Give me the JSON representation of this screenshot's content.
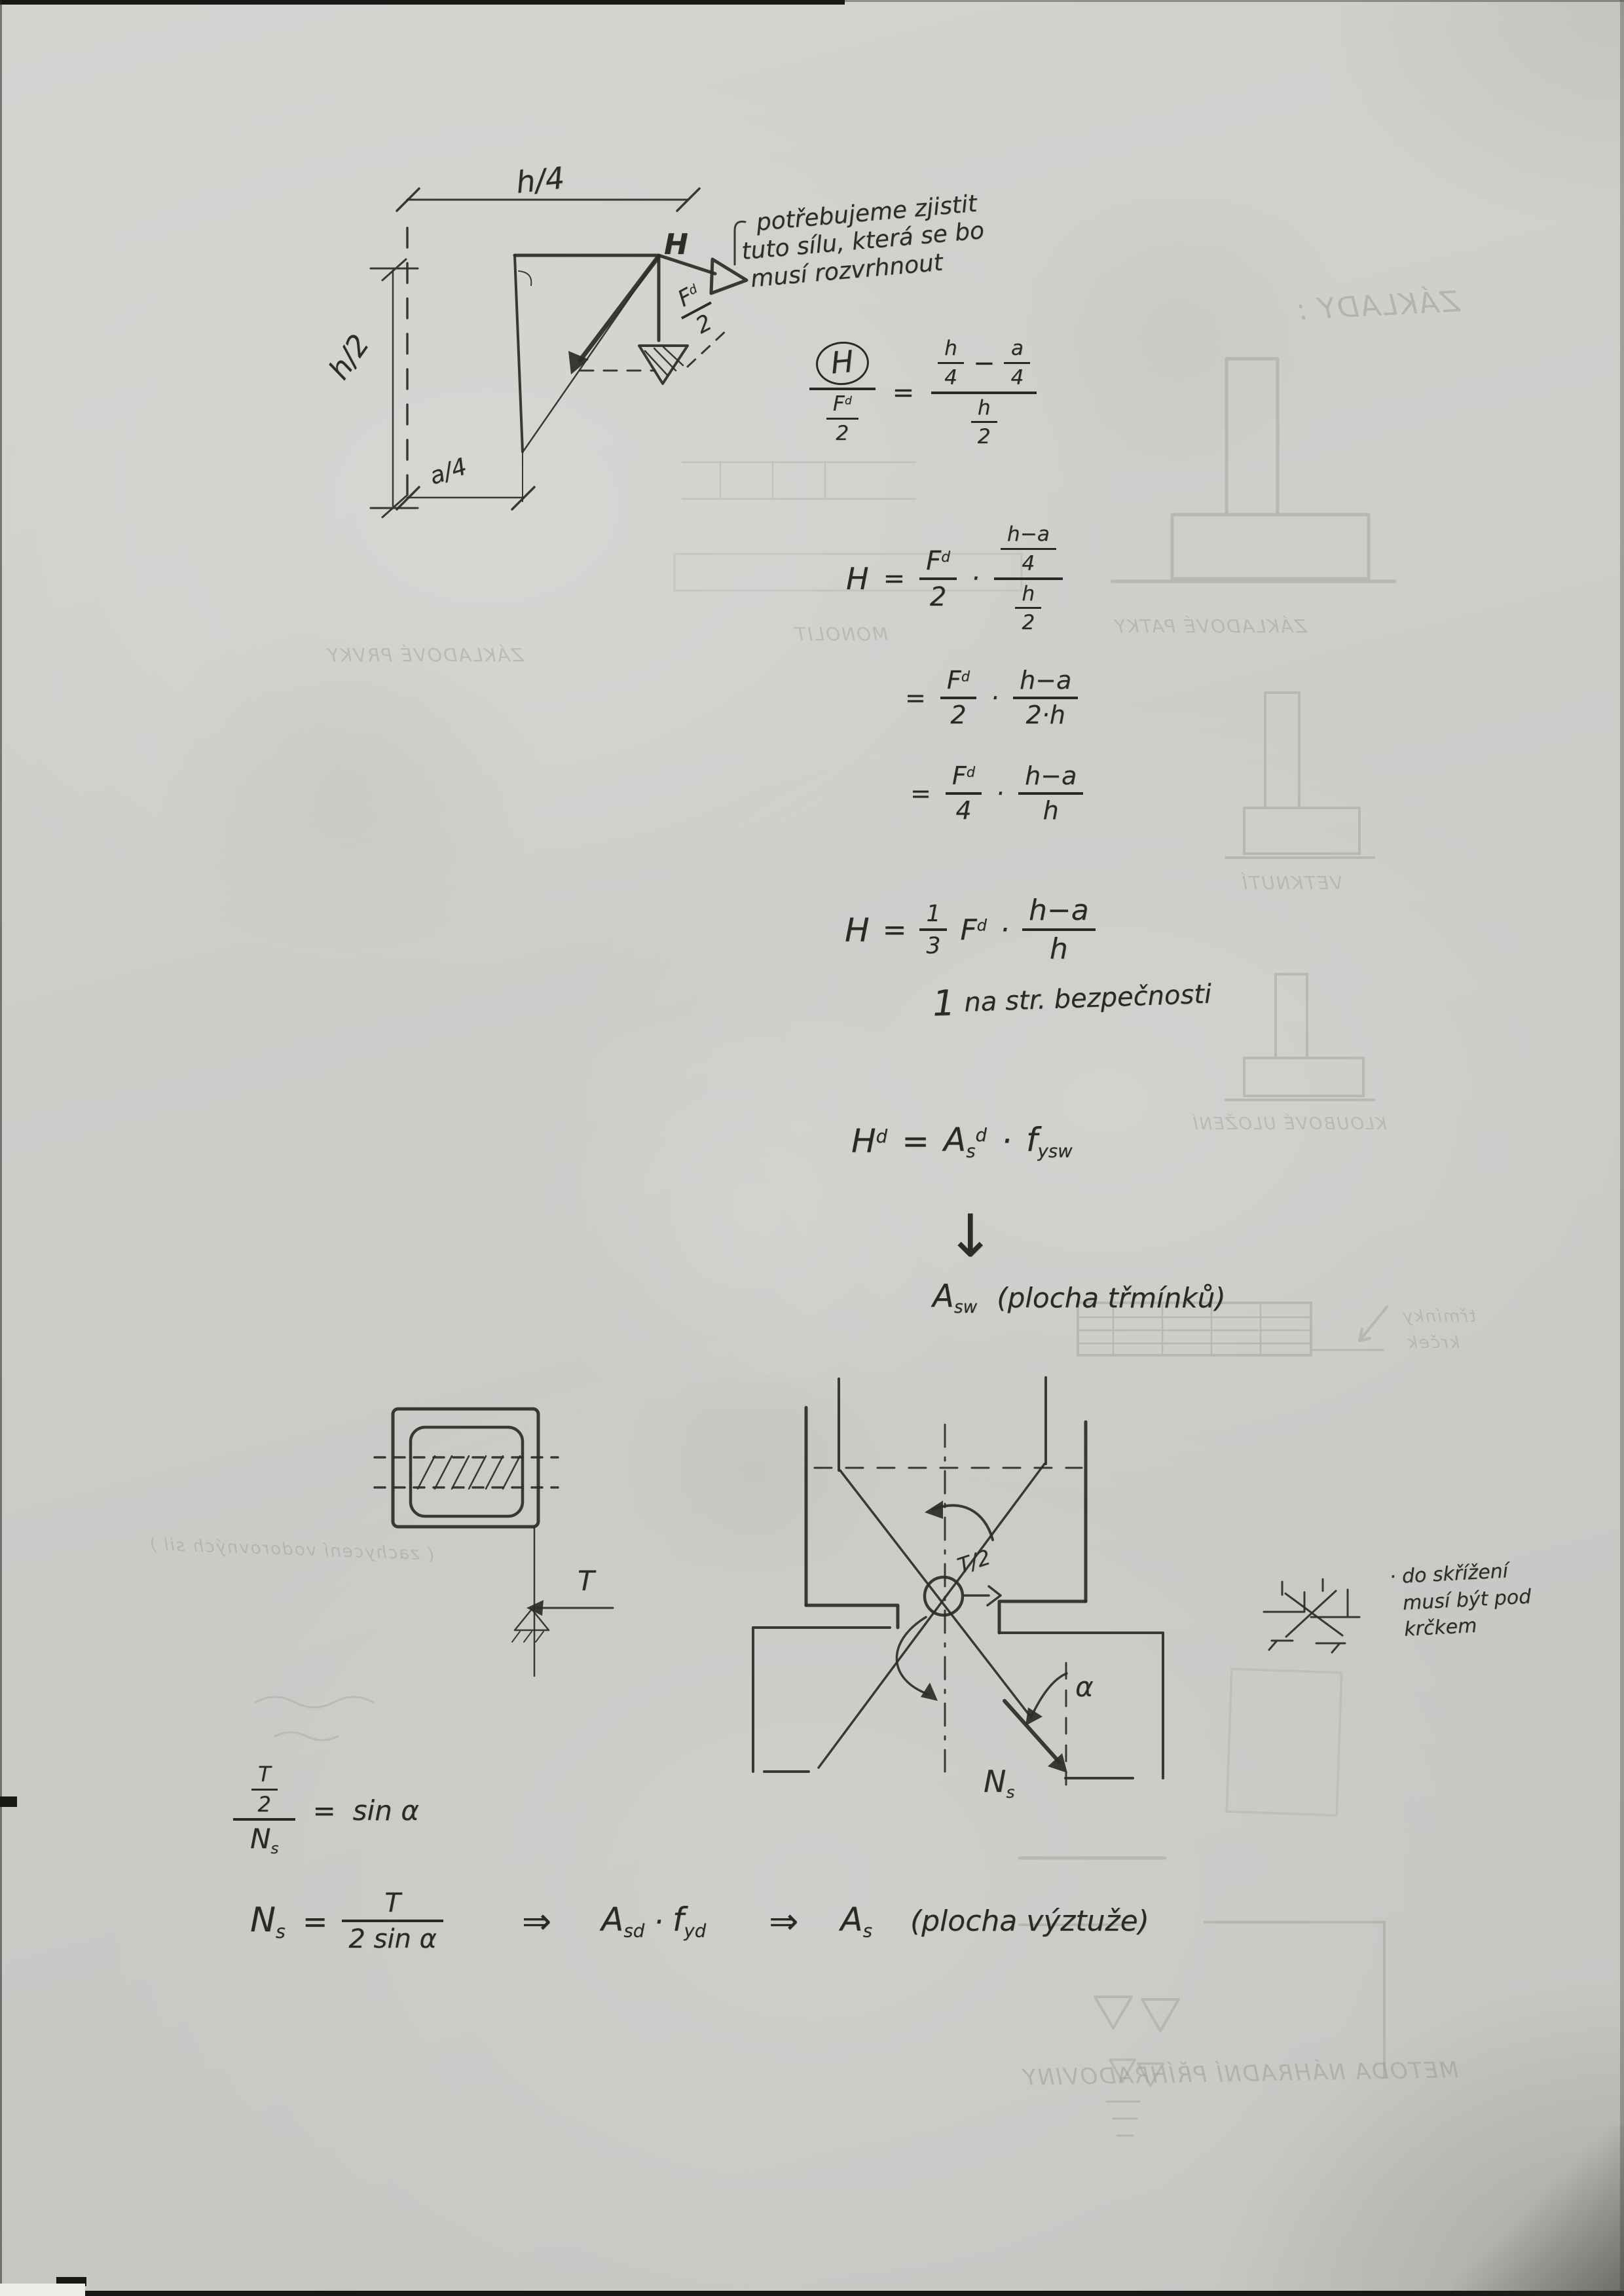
{
  "top_diagram": {
    "dim_top": "h/4",
    "dim_left": "h/2",
    "dim_bottom": "a/4",
    "h_label": "H",
    "f_base": "F",
    "f_sup": "d",
    "f_den": "2"
  },
  "note_top": {
    "line1": "potřebujeme zjistit",
    "line2": "tuto sílu, která se bo",
    "line3": "musí rozvrhnout"
  },
  "eq1": {
    "num": "H",
    "den_base": "F",
    "den_sup": "d",
    "den_den": "2",
    "eq": "=",
    "r1_num": "h",
    "r1_den": "4",
    "minus": "−",
    "r2_num": "a",
    "r2_den": "4",
    "rden_num": "h",
    "rden_den": "2"
  },
  "eq2": {
    "lhs": "H",
    "eq": "=",
    "f_base": "F",
    "f_sup": "d",
    "f_den": "2",
    "dot": "·",
    "n_num": "h−a",
    "n_den": "4",
    "d_num": "h",
    "d_den": "2"
  },
  "eq3": {
    "eq": "=",
    "f_base": "F",
    "f_sup": "d",
    "f_den": "2",
    "dot": "·",
    "num": "h−a",
    "den": "2·h"
  },
  "eq4": {
    "eq": "=",
    "f_base": "F",
    "f_sup": "d",
    "f_den": "4",
    "dot": "·",
    "num": "h−a",
    "den": "h"
  },
  "eq5": {
    "lhs": "H",
    "eq": "=",
    "c_num": "1",
    "c_den": "3",
    "f_base": "F",
    "f_sup": "d",
    "dot": "·",
    "num": "h−a",
    "den": "h"
  },
  "eq5_note": {
    "lead": "1",
    "text": "na str. bezpečnosti"
  },
  "eq6": {
    "lhs_base": "H",
    "lhs_sup": "d",
    "eq": "=",
    "a_base": "A",
    "a_sub": "s",
    "a_sup": "d",
    "dot": "·",
    "f_base": "f",
    "f_sub": "ysw"
  },
  "arrow_down": "↓",
  "asw": {
    "base": "A",
    "sub": "sw",
    "paren": "(plocha třmínků)"
  },
  "section_sketch": {
    "t_label": "T"
  },
  "x_diagram": {
    "t2": "T/2",
    "alpha": "α",
    "n_base": "N",
    "n_sub": "s"
  },
  "note_right": {
    "line1": "· do skřížení",
    "line2": "musí být pod",
    "line3": "krčkem"
  },
  "eq7": {
    "t": "T",
    "two": "2",
    "n_base": "N",
    "n_sub": "s",
    "eq": "=",
    "rhs": "sin α"
  },
  "eq8": {
    "n_base": "N",
    "n_sub": "s",
    "eq": "=",
    "num": "T",
    "den": "2 sin α",
    "arr1": "⇒",
    "a1_base": "A",
    "a1_sub": "sd",
    "dot": "·",
    "f_base": "f",
    "f_sub": "yd",
    "arr2": "⇒",
    "a2_base": "A",
    "a2_sub": "s",
    "paren": "(plocha výztuže)"
  },
  "bleedthrough": {
    "heading": "ZÁKLADY :",
    "patky": "ZÁKLADOVÉ PATKY",
    "monolit": "MONOLIT",
    "prvky": "ZÁKLADOVÉ PRVKY",
    "vetknuti": "VETKNUTÍ",
    "kloub": "KLOUBOVÉ ULOŽENÍ",
    "krcek1": "třmínky",
    "krcek2": "krček",
    "bottom_line": "METODA NÁHRADNÍ PŘÍHRADOVINY",
    "left_line": "( zachycení vodorovných sil )"
  }
}
